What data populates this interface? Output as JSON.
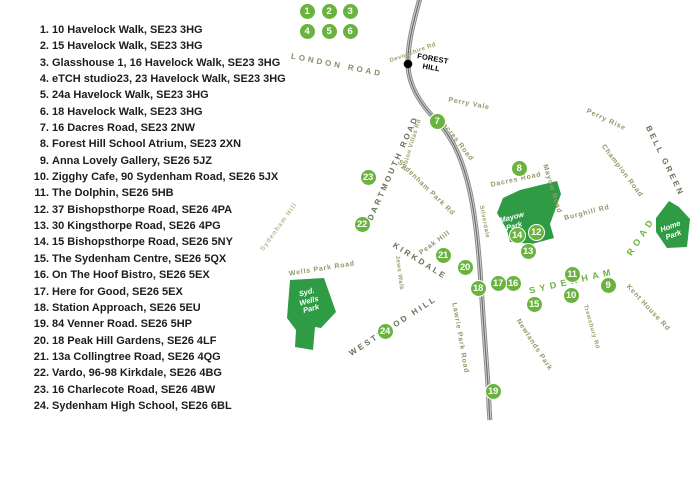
{
  "legend": {
    "items": [
      {
        "num": "1.",
        "text": "10 Havelock Walk, SE23 3HG"
      },
      {
        "num": "2.",
        "text": "15 Havelock Walk, SE23 3HG"
      },
      {
        "num": "3.",
        "text": "Glasshouse 1, 16 Havelock Walk, SE23 3HG"
      },
      {
        "num": "4.",
        "text": "eTCH studio23, 23 Havelock Walk, SE23 3HG"
      },
      {
        "num": "5.",
        "text": "24a Havelock Walk, SE23 3HG"
      },
      {
        "num": "6.",
        "text": "18 Havelock Walk, SE23 3HG"
      },
      {
        "num": "7.",
        "text": "16 Dacres Road, SE23 2NW"
      },
      {
        "num": "8.",
        "text": "Forest Hill School Atrium, SE23 2XN"
      },
      {
        "num": "9.",
        "text": "Anna Lovely Gallery, SE26 5JZ"
      },
      {
        "num": "10.",
        "text": "Zigghy Cafe, 90 Sydenham Road, SE26 5JX"
      },
      {
        "num": "11.",
        "text": "The Dolphin, SE26 5HB"
      },
      {
        "num": "12.",
        "text": "37 Bishopsthorpe Road, SE26 4PA"
      },
      {
        "num": "13.",
        "text": "30 Kingsthorpe Road, SE26 4PG"
      },
      {
        "num": "14.",
        "text": "15 Bishopsthorpe Road, SE26 5NY"
      },
      {
        "num": "15.",
        "text": "The Sydenham Centre, SE26 5QX"
      },
      {
        "num": "16.",
        "text": "On The Hoof Bistro, SE26 5EX"
      },
      {
        "num": "17.",
        "text": "Here for Good, SE26 5EX"
      },
      {
        "num": "18.",
        "text": "Station Approach, SE26 5EU"
      },
      {
        "num": "19.",
        "text": "84 Venner Road. SE26 5HP"
      },
      {
        "num": "20.",
        "text": "18 Peak Hill Gardens, SE26 4LF"
      },
      {
        "num": "21.",
        "text": "13a Collingtree Road, SE26 4QG"
      },
      {
        "num": "22.",
        "text": "Vardo, 96-98 Kirkdale, SE26 4BG"
      },
      {
        "num": "23.",
        "text": "16 Charlecote Road, SE26 4BW"
      },
      {
        "num": "24.",
        "text": "Sydenham High School, SE26 6BL"
      }
    ]
  },
  "map": {
    "colors": {
      "marker_green": "#6ab33f",
      "park_green": "#2f9b45",
      "rail_gray": "#909090",
      "road_label_olive": "#939866",
      "road_label_dark": "#657257",
      "highlight_road_green": "#6ab33f",
      "text_black": "#1d1d1b"
    },
    "station": {
      "line1": "FOREST",
      "line2": "HILL"
    },
    "markers": [
      {
        "n": "1",
        "x": 307,
        "y": 11
      },
      {
        "n": "2",
        "x": 329,
        "y": 11
      },
      {
        "n": "3",
        "x": 350,
        "y": 11
      },
      {
        "n": "4",
        "x": 307,
        "y": 31
      },
      {
        "n": "5",
        "x": 329,
        "y": 31
      },
      {
        "n": "6",
        "x": 350,
        "y": 31
      },
      {
        "n": "7",
        "x": 437,
        "y": 121
      },
      {
        "n": "8",
        "x": 519,
        "y": 168
      },
      {
        "n": "9",
        "x": 608,
        "y": 285
      },
      {
        "n": "10",
        "x": 571,
        "y": 295
      },
      {
        "n": "11",
        "x": 572,
        "y": 274
      },
      {
        "n": "12",
        "x": 536,
        "y": 232
      },
      {
        "n": "13",
        "x": 528,
        "y": 251
      },
      {
        "n": "14",
        "x": 517,
        "y": 235
      },
      {
        "n": "15",
        "x": 534,
        "y": 304
      },
      {
        "n": "16",
        "x": 513,
        "y": 283
      },
      {
        "n": "17",
        "x": 498,
        "y": 283
      },
      {
        "n": "18",
        "x": 478,
        "y": 288
      },
      {
        "n": "19",
        "x": 493,
        "y": 391
      },
      {
        "n": "20",
        "x": 465,
        "y": 267
      },
      {
        "n": "21",
        "x": 443,
        "y": 255
      },
      {
        "n": "22",
        "x": 362,
        "y": 224
      },
      {
        "n": "23",
        "x": 368,
        "y": 177
      },
      {
        "n": "24",
        "x": 385,
        "y": 331
      }
    ],
    "road_labels": [
      {
        "text": "LONDON ROAD",
        "x": 337,
        "y": 65,
        "rot": 11,
        "style": "caps-light"
      },
      {
        "text": "Devonshire Rd",
        "x": 413,
        "y": 53,
        "rot": -20,
        "style": "tiny"
      },
      {
        "text": "Perry Vale",
        "x": 469,
        "y": 104,
        "rot": 11,
        "style": "minor"
      },
      {
        "text": "Perry Rise",
        "x": 606,
        "y": 120,
        "rot": 25,
        "style": "minor"
      },
      {
        "text": "BELL GREEN",
        "x": 665,
        "y": 161,
        "rot": 64,
        "style": "caps"
      },
      {
        "text": "Champion Road",
        "x": 622,
        "y": 171,
        "rot": 53,
        "style": "minor"
      },
      {
        "text": "Burghill Rd",
        "x": 587,
        "y": 213,
        "rot": -14,
        "style": "minor"
      },
      {
        "text": "Mayow Road",
        "x": 552,
        "y": 189,
        "rot": 73,
        "style": "minor"
      },
      {
        "text": "Dacres Road",
        "x": 456,
        "y": 140,
        "rot": 52,
        "style": "minor"
      },
      {
        "text": "Dacres Road",
        "x": 516,
        "y": 180,
        "rot": -12,
        "style": "minor"
      },
      {
        "text": "DARTMOUTH ROAD",
        "x": 393,
        "y": 168,
        "rot": -66,
        "style": "caps"
      },
      {
        "text": "Albion Villas Rd",
        "x": 412,
        "y": 145,
        "rot": -73,
        "style": "tiny"
      },
      {
        "text": "Sydenham Park Rd",
        "x": 426,
        "y": 188,
        "rot": 44,
        "style": "minor"
      },
      {
        "text": "Silverdale",
        "x": 484,
        "y": 222,
        "rot": 79,
        "style": "tiny"
      },
      {
        "text": "Sydenham Hill",
        "x": 279,
        "y": 227,
        "rot": -54,
        "style": "light"
      },
      {
        "text": "KIRKDALE",
        "x": 420,
        "y": 261,
        "rot": 32,
        "style": "caps"
      },
      {
        "text": "Peak Hill",
        "x": 435,
        "y": 243,
        "rot": -36,
        "style": "minor"
      },
      {
        "text": "Wells Park Road",
        "x": 322,
        "y": 269,
        "rot": -9,
        "style": "minor"
      },
      {
        "text": "Jews Walk",
        "x": 399,
        "y": 273,
        "rot": 83,
        "style": "tiny"
      },
      {
        "text": "WESTWOOD HILL",
        "x": 393,
        "y": 326,
        "rot": -33,
        "style": "caps"
      },
      {
        "text": "Lawrie Park Road",
        "x": 460,
        "y": 338,
        "rot": 80,
        "style": "minor"
      },
      {
        "text": "Newlands Park",
        "x": 534,
        "y": 345,
        "rot": 57,
        "style": "minor"
      },
      {
        "text": "Trewsbury Rd",
        "x": 591,
        "y": 327,
        "rot": 74,
        "style": "tiny"
      },
      {
        "text": "Kent House Rd",
        "x": 648,
        "y": 308,
        "rot": 47,
        "style": "minor"
      },
      {
        "text": "SYDENHAM",
        "x": 572,
        "y": 281,
        "rot": -13,
        "style": "green"
      },
      {
        "text": "ROAD",
        "x": 641,
        "y": 236,
        "rot": -57,
        "style": "green"
      }
    ],
    "parks": [
      {
        "id": "mayow-park",
        "label_lines": [
          "Mayow",
          "Park"
        ],
        "label_x": 513,
        "label_y": 222,
        "label_rot": -15
      },
      {
        "id": "syd-wells-park",
        "label_lines": [
          "Syd.",
          "Wells",
          "Park"
        ],
        "label_x": 309,
        "label_y": 301,
        "label_rot": -15
      },
      {
        "id": "home-park",
        "label_lines": [
          "Home",
          "Park"
        ],
        "label_x": 672,
        "label_y": 231,
        "label_rot": -20
      }
    ]
  }
}
